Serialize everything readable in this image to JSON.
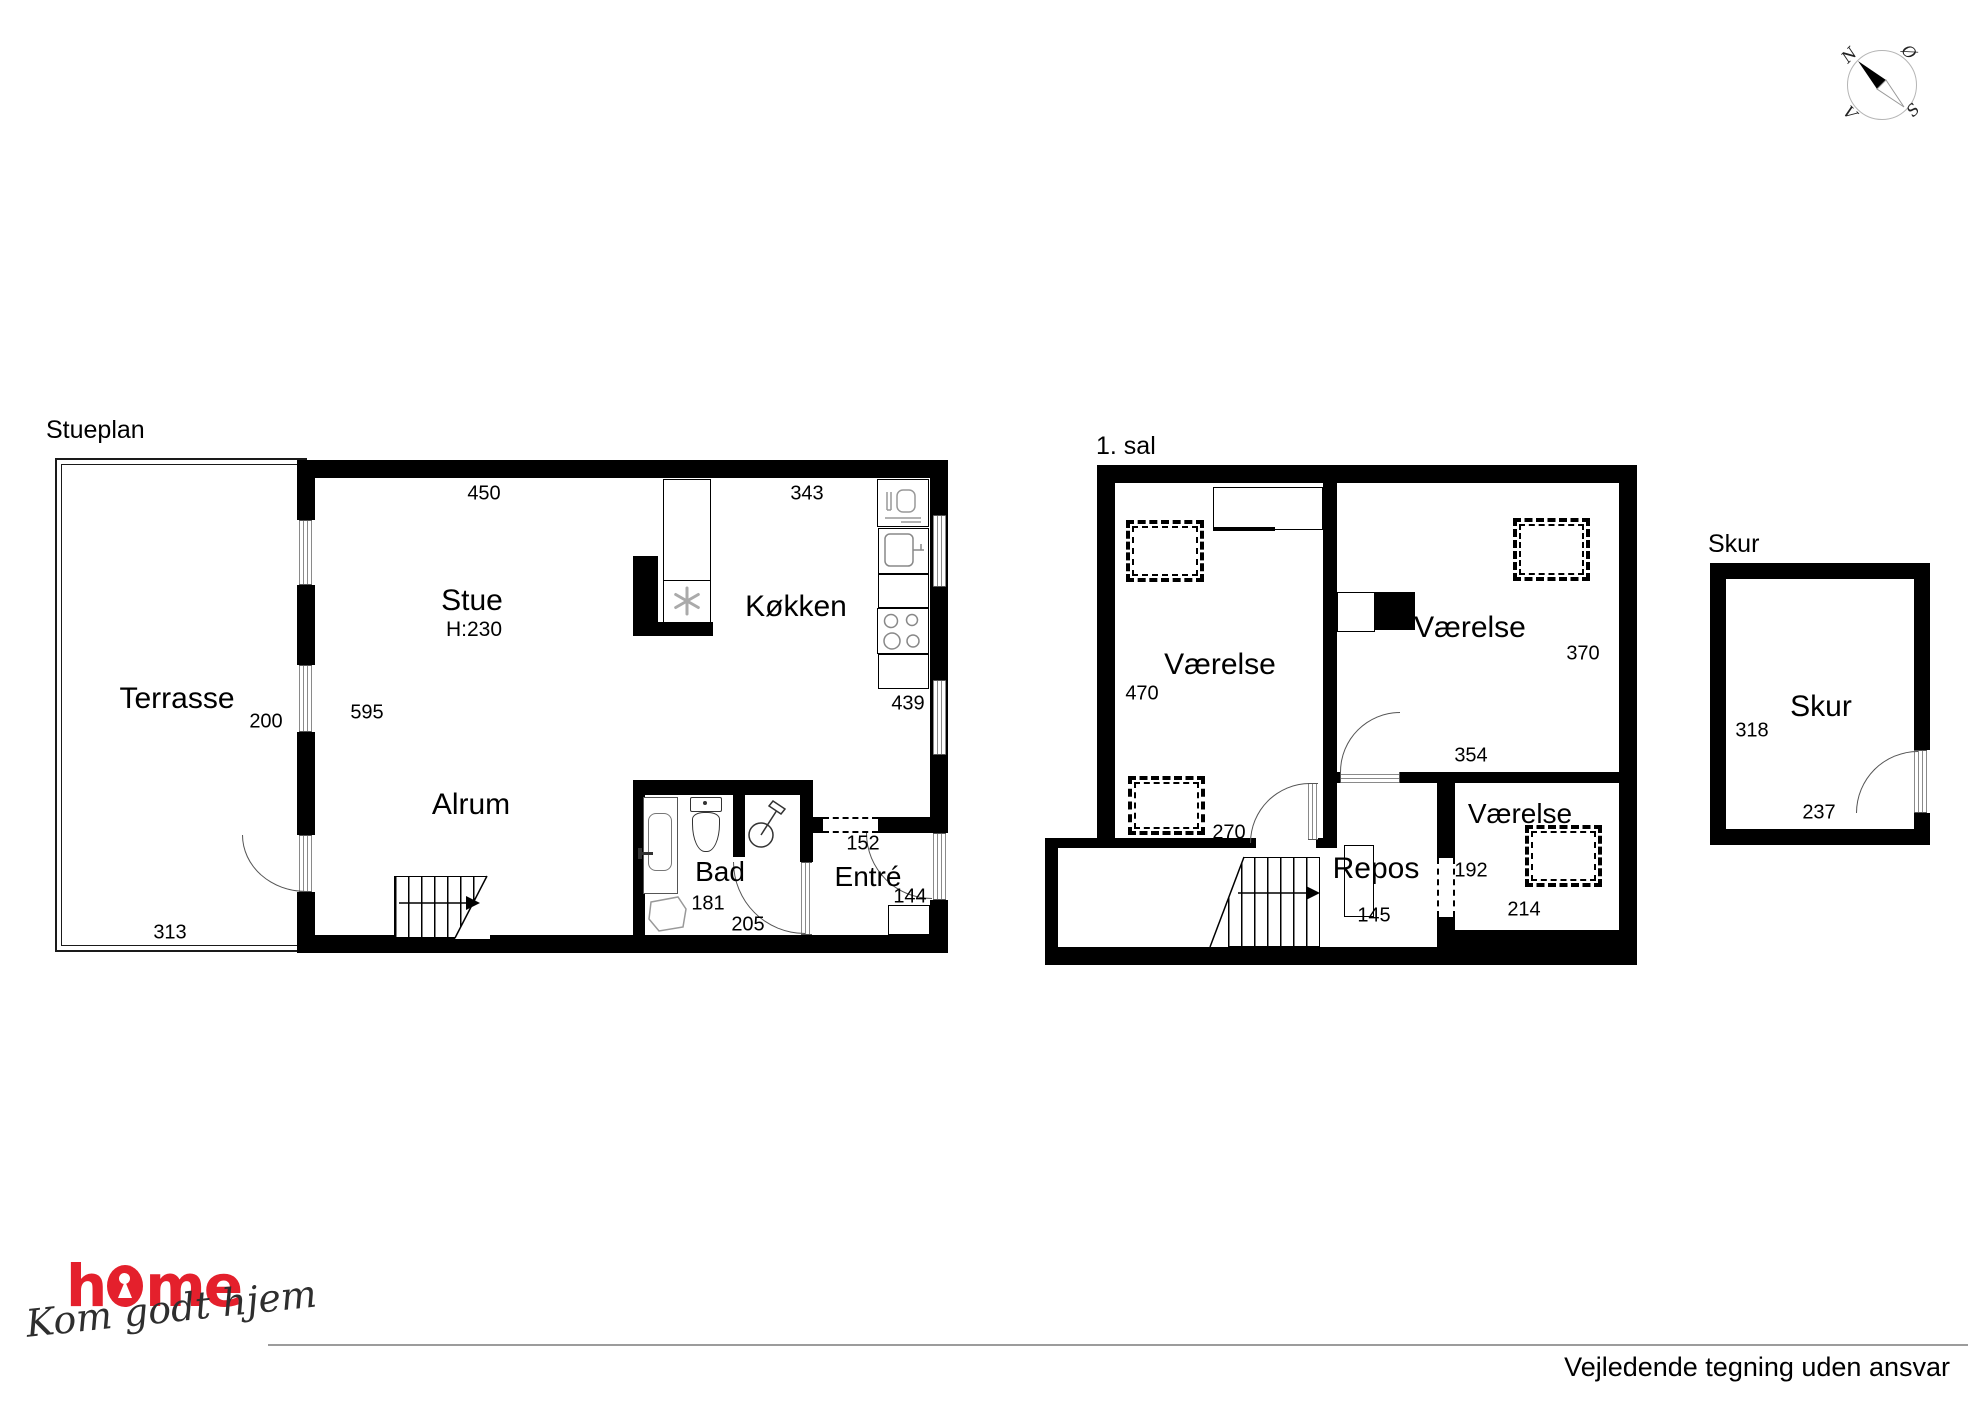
{
  "stueplan": {
    "title": "Stueplan",
    "terrasse": {
      "label": "Terrasse",
      "width": "313",
      "depth": "200"
    },
    "stue": {
      "label": "Stue",
      "ceiling": "H:230",
      "width": "450",
      "depth": "595"
    },
    "kokken": {
      "label": "Køkken",
      "width": "343",
      "depth": "439"
    },
    "alrum": {
      "label": "Alrum"
    },
    "bad": {
      "label": "Bad",
      "width": "181",
      "depth": "205"
    },
    "entre": {
      "label": "Entré",
      "opening": "152",
      "width": "144"
    }
  },
  "first_floor": {
    "title": "1. sal",
    "room_left": {
      "label": "Værelse",
      "depth": "470",
      "width": "270"
    },
    "room_right": {
      "label": "Værelse",
      "depth": "370",
      "width": "354"
    },
    "room_small": {
      "label": "Værelse",
      "width": "192",
      "depth": "214"
    },
    "repos": {
      "label": "Repos",
      "width": "145"
    }
  },
  "skur": {
    "title": "Skur",
    "label": "Skur",
    "depth": "318",
    "width": "237"
  },
  "compass": {
    "north": "N",
    "east": "Ø",
    "south": "S",
    "west": "V"
  },
  "branding": {
    "logo_start": "h",
    "logo_end": "me",
    "logo_color": "#e4202c",
    "tagline": "Kom godt hjem"
  },
  "footer": {
    "disclaimer": "Vejledende tegning uden ansvar"
  }
}
